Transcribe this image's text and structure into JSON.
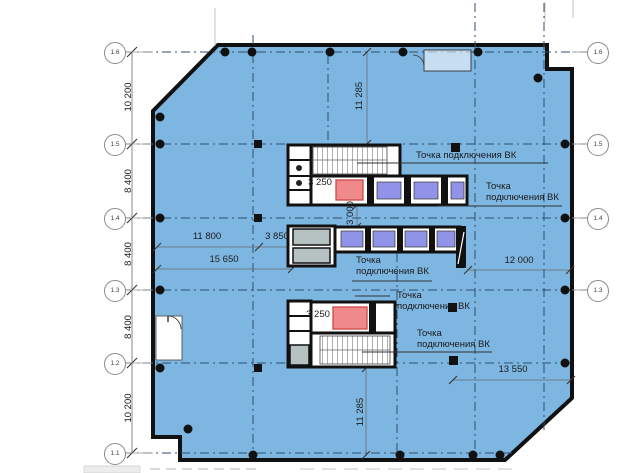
{
  "drawing": {
    "type": "floor-plan",
    "colors": {
      "floor_fill": "#7eb6e2",
      "wall": "#111111",
      "elevator_purple": "#9093e8",
      "elevator_red": "#f08a8a",
      "room_gray": "#b6c2c2",
      "grid_dash": "#2e4e6e"
    }
  },
  "axis_bubbles": {
    "left": [
      "1.6",
      "1.5",
      "1.4",
      "1.3",
      "1.2",
      "1.1"
    ],
    "right": [
      "1.6",
      "1.5",
      "1.4",
      "1.3"
    ]
  },
  "dims": {
    "left_10200_top": "10 200",
    "left_8400_a": "8 400",
    "left_8400_b": "8 400",
    "left_8400_c": "8 400",
    "left_10200_bottom": "10 200",
    "v_11285_top": "11 285",
    "v_3000": "3 000",
    "v_11285_bottom": "11 285",
    "core_3250_top": "3 250",
    "core_3250_bottom": "3 250",
    "w_11800": "11 800",
    "w_3850": "3 850",
    "w_15650": "15 650",
    "w_12000": "12 000",
    "w_13550": "13 550"
  },
  "labels": {
    "vk_top": "Точка подключения ВК",
    "vk_right_1": "Точка",
    "vk_right_2": "подключения ВК",
    "vk_mid_1": "Точка",
    "vk_mid_2": "подключения ВК",
    "vk_low1_1": "Точка",
    "vk_low1_2": "подключения ВК",
    "vk_low2_1": "Точка",
    "vk_low2_2": "подключения ВК"
  }
}
